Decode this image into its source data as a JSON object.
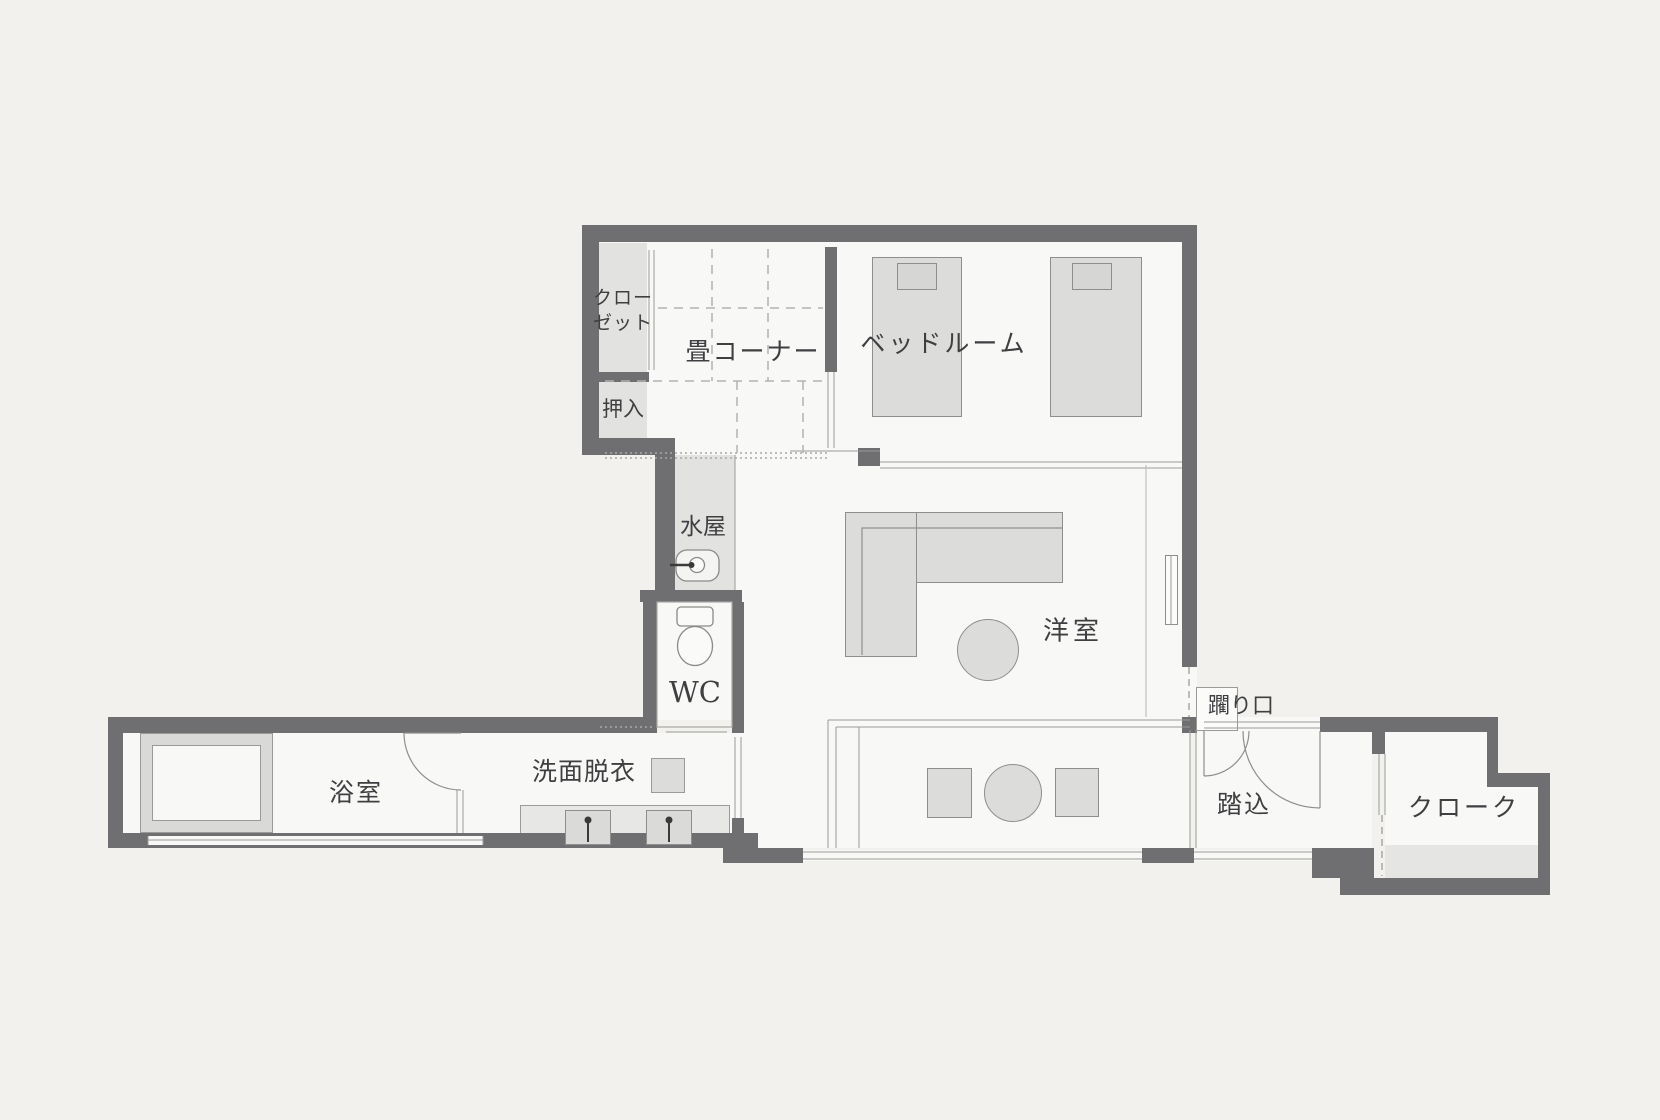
{
  "plan": {
    "type": "floor-plan",
    "labels": {
      "closet_line1": "クロー",
      "closet_line2": "ゼット",
      "oshiire": "押入",
      "tatami_corner": "畳コーナー",
      "bedroom": "ベッドルーム",
      "mizuya": "水屋",
      "wc": "WC",
      "western_room": "洋室",
      "bathroom": "浴室",
      "washroom": "洗面脱衣",
      "nijiriguchi": "躙り口",
      "entry": "踏込",
      "cloak": "クローク"
    },
    "colors": {
      "background": "#f2f1ee",
      "room": "#f8f8f6",
      "wall": "#6f6f71",
      "furniture": "#dcdcda",
      "furniture_border": "#8e8e8c",
      "closet_fill": "#e2e2e0",
      "text": "#3f3f41"
    }
  }
}
